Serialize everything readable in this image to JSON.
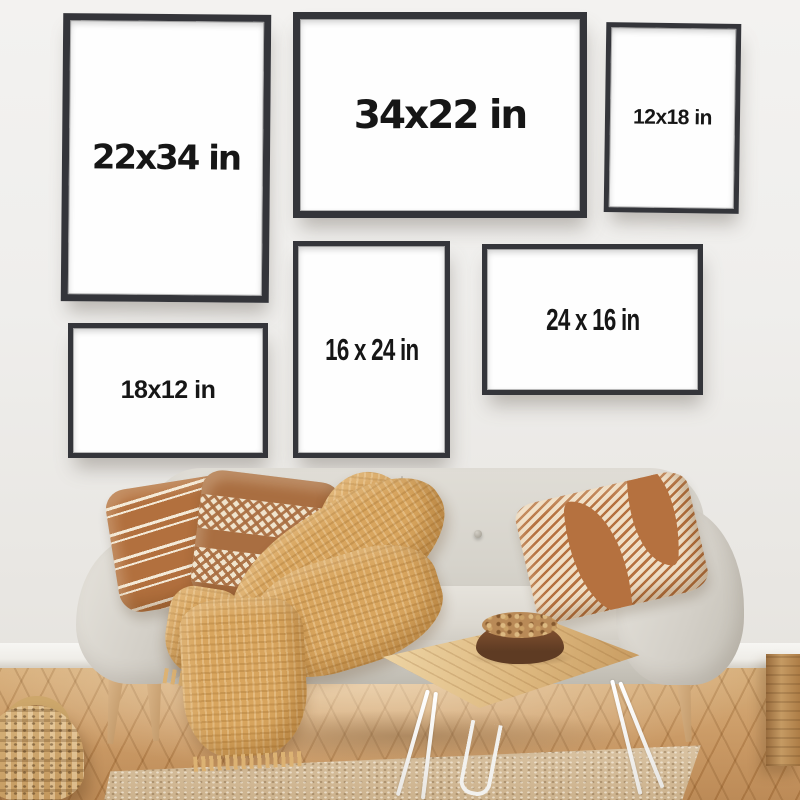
{
  "frames": [
    {
      "label": "22x34 in",
      "orientation": "portrait"
    },
    {
      "label": "34x22 in",
      "orientation": "landscape"
    },
    {
      "label": "12x18 in",
      "orientation": "portrait"
    },
    {
      "label": "18x12 in",
      "orientation": "landscape"
    },
    {
      "label": "16 x 24 in",
      "orientation": "portrait"
    },
    {
      "label": "24 x 16 in",
      "orientation": "landscape"
    }
  ],
  "colors": {
    "wall": "#efeeec",
    "frame_border": "#34353a",
    "frame_face": "#fefefe",
    "label_text": "#161616",
    "sofa_fabric": "#d6d3cb",
    "pillow_rust": "#b2703e",
    "pillow_cream": "#f0e4cd",
    "throw_blanket": "#d8a55e",
    "floor_wood": "#c4915b",
    "rug_jute": "#d6c0a0",
    "basket_weave": "#c89f63",
    "table_wood": "#ddb87f",
    "hairpin_legs": "#f2f1ee",
    "bowl_wood": "#6b4228"
  },
  "scene_objects": {
    "sofa": "light gray fabric loveseat",
    "pillows": "rust striped, diamond pattern and geometric striped cushions",
    "throw": "camel waffle-knit blanket with fringe",
    "table": "live-edge wood coffee table with white hairpin legs",
    "bowl": "wooden bowl with nuts",
    "rug": "woven jute rug",
    "basket": "woven seagrass basket",
    "floor": "herringbone wood floor"
  }
}
